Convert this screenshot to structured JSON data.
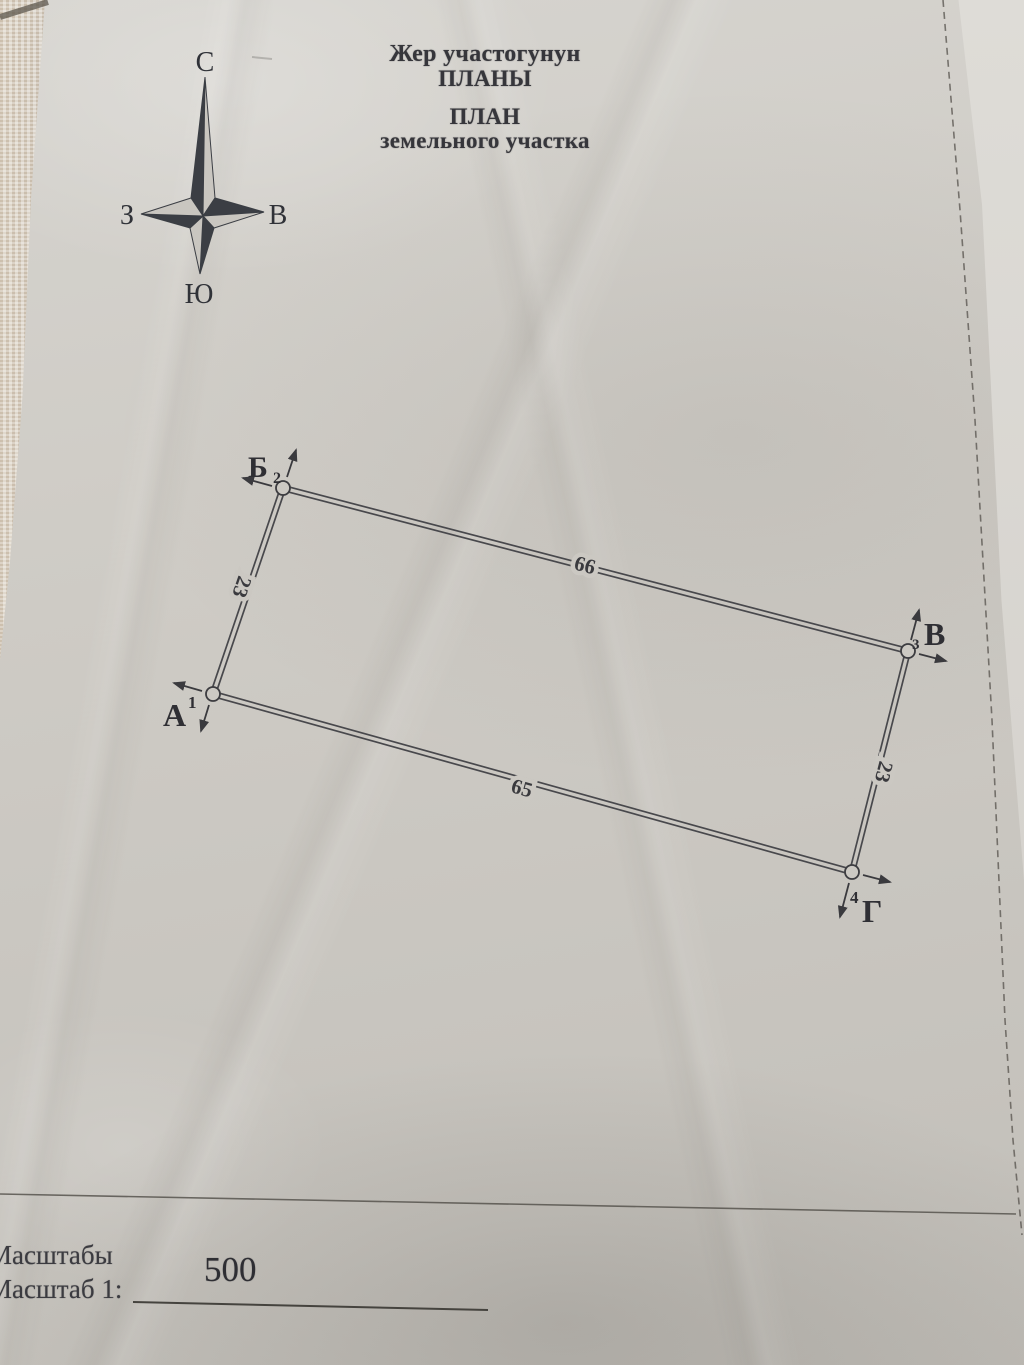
{
  "title": {
    "kg_line1": "Жер участогунун",
    "kg_line2": "ПЛАНЫ",
    "ru_line1": "ПЛАН",
    "ru_line2": "земельного участка"
  },
  "compass": {
    "north": "С",
    "south": "Ю",
    "west": "З",
    "east": "В"
  },
  "plot": {
    "corners": {
      "a": {
        "label": "А",
        "number": "1"
      },
      "b": {
        "label": "Б",
        "number": "2"
      },
      "v": {
        "label": "В",
        "number": "3"
      },
      "g": {
        "label": "Г",
        "number": "4"
      }
    },
    "sides": {
      "top": "66",
      "bottom": "65",
      "left": "23",
      "right": "23"
    }
  },
  "scale": {
    "line1": "Масштабы",
    "line2": "Масштаб 1:",
    "value": "500"
  },
  "colors": {
    "paper": "#cdcac4",
    "ink": "#37373c",
    "line": "#48484c"
  }
}
